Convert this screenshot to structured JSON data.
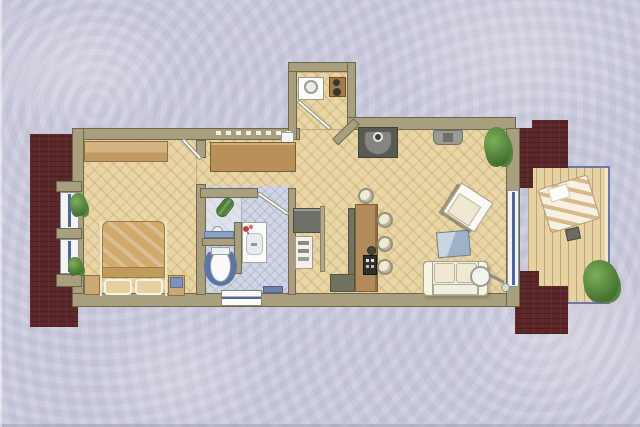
{
  "scene": {
    "type": "apartment-floor-plan",
    "style": "hand-colored architectural rendering, top-down view",
    "description": "Color floor plan of a one-bedroom apartment with balcony on a lavender swirl background",
    "contains_text": false
  },
  "palette": {
    "background": "#cbcbdc",
    "background_swirl_highlight": "#dcdce8",
    "wall": "#a89f7e",
    "wall_outline": "#6e6750",
    "exterior_shadow_mass": "#5b2628",
    "parquet": "#e9d6a6",
    "parquet_line": "#a67c3e",
    "bathroom_tile": "#d0d6e3",
    "balcony_deck": "#e6d2a2",
    "railing_blue": "#6b79a8",
    "window_glazing": "#4c67a0",
    "furniture_wood": "#c9a876",
    "bar_counter": "#b18b59",
    "upholstery_cream": "#f1edda",
    "tv_unit_gray": "#575b51",
    "coffee_table_blue": "#9db2c5",
    "toilet_rug_blue": "#5b76a5",
    "plant_green": "#4c7c38"
  },
  "rooms": [
    {
      "id": "bedroom",
      "floor": "parquet",
      "features": [
        "double-bed",
        "pillows",
        "blanket",
        "wardrobe",
        "nightstand-left",
        "nightstand-right",
        "window-bay-upper",
        "window-bay-lower",
        "potted-plants"
      ]
    },
    {
      "id": "bathroom",
      "floor": "blue-tile",
      "features": [
        "shower-tray",
        "floor-drain",
        "loofah",
        "bath-mat",
        "toilet",
        "horseshoe-rug",
        "vanity-sink",
        "flowers"
      ]
    },
    {
      "id": "kitchen-niche",
      "floor": "parquet",
      "features": [
        "washing-machine",
        "two-burner-cooktop",
        "door-swing",
        "counter-table",
        "sink-unit",
        "radiator-dashes"
      ]
    },
    {
      "id": "living-dining",
      "floor": "parquet",
      "features": [
        "bar-counter",
        "four-bar-stools",
        "hifi-on-counter",
        "sofa",
        "floor-lamp",
        "coffee-table",
        "armchair",
        "tv-corner-cabinet",
        "media-console",
        "potted-plant"
      ]
    },
    {
      "id": "hallway",
      "floor": "parquet",
      "features": [
        "wardrobe",
        "shoe-shelf",
        "entrance-threshold",
        "doormat"
      ]
    },
    {
      "id": "balcony",
      "floor": "wood-deck",
      "features": [
        "glass-railing",
        "sun-lounger",
        "slippers",
        "potted-plant"
      ]
    }
  ]
}
